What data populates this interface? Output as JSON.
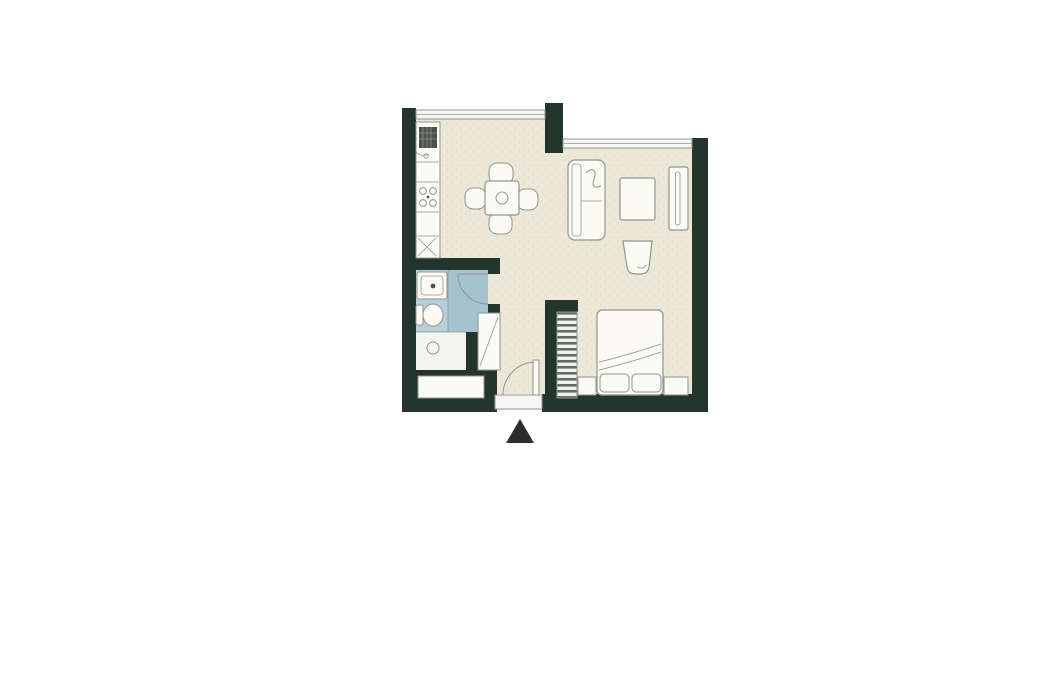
{
  "page": {
    "background": "#ffffff",
    "content_type": "apartment-floor-plan"
  },
  "colors": {
    "wall": "#24352d",
    "floor": "#ece8d8",
    "floorSpeckle": "#ded9c3",
    "bathFloor": "#b7cfda",
    "showerFloor": "#a5c2d0",
    "utilityFloor": "#f4f4ee",
    "furniture": "#fbfaf4",
    "outline": "#8f968f",
    "applianceDark": "#4c524c",
    "applianceGrid": "#8a908a",
    "windowFill": "#f6f6f2",
    "entrance": "#2d2d2d"
  },
  "floor_plan": {
    "style": "studio-apartment",
    "entrance_marker": "solid-triangle-pointing-up",
    "rooms": [
      "kitchen",
      "dining-area",
      "living-area",
      "sleeping-area",
      "bathroom",
      "entry-hall"
    ],
    "fixtures_and_furniture": [
      "refrigerator",
      "kitchen-counter",
      "cooktop-4-burners",
      "kitchen-sink",
      "dining-table-with-4-chairs",
      "sofa",
      "coffee-table",
      "armchair",
      "tv-console",
      "double-bed",
      "pillows",
      "nightstand-left",
      "nightstand-right",
      "wardrobe-with-rail",
      "bathroom-sink",
      "toilet",
      "shower-with-curved-door",
      "floor-drain",
      "hall-closet",
      "entry-cabinet",
      "entry-door-with-swing",
      "windows"
    ]
  }
}
